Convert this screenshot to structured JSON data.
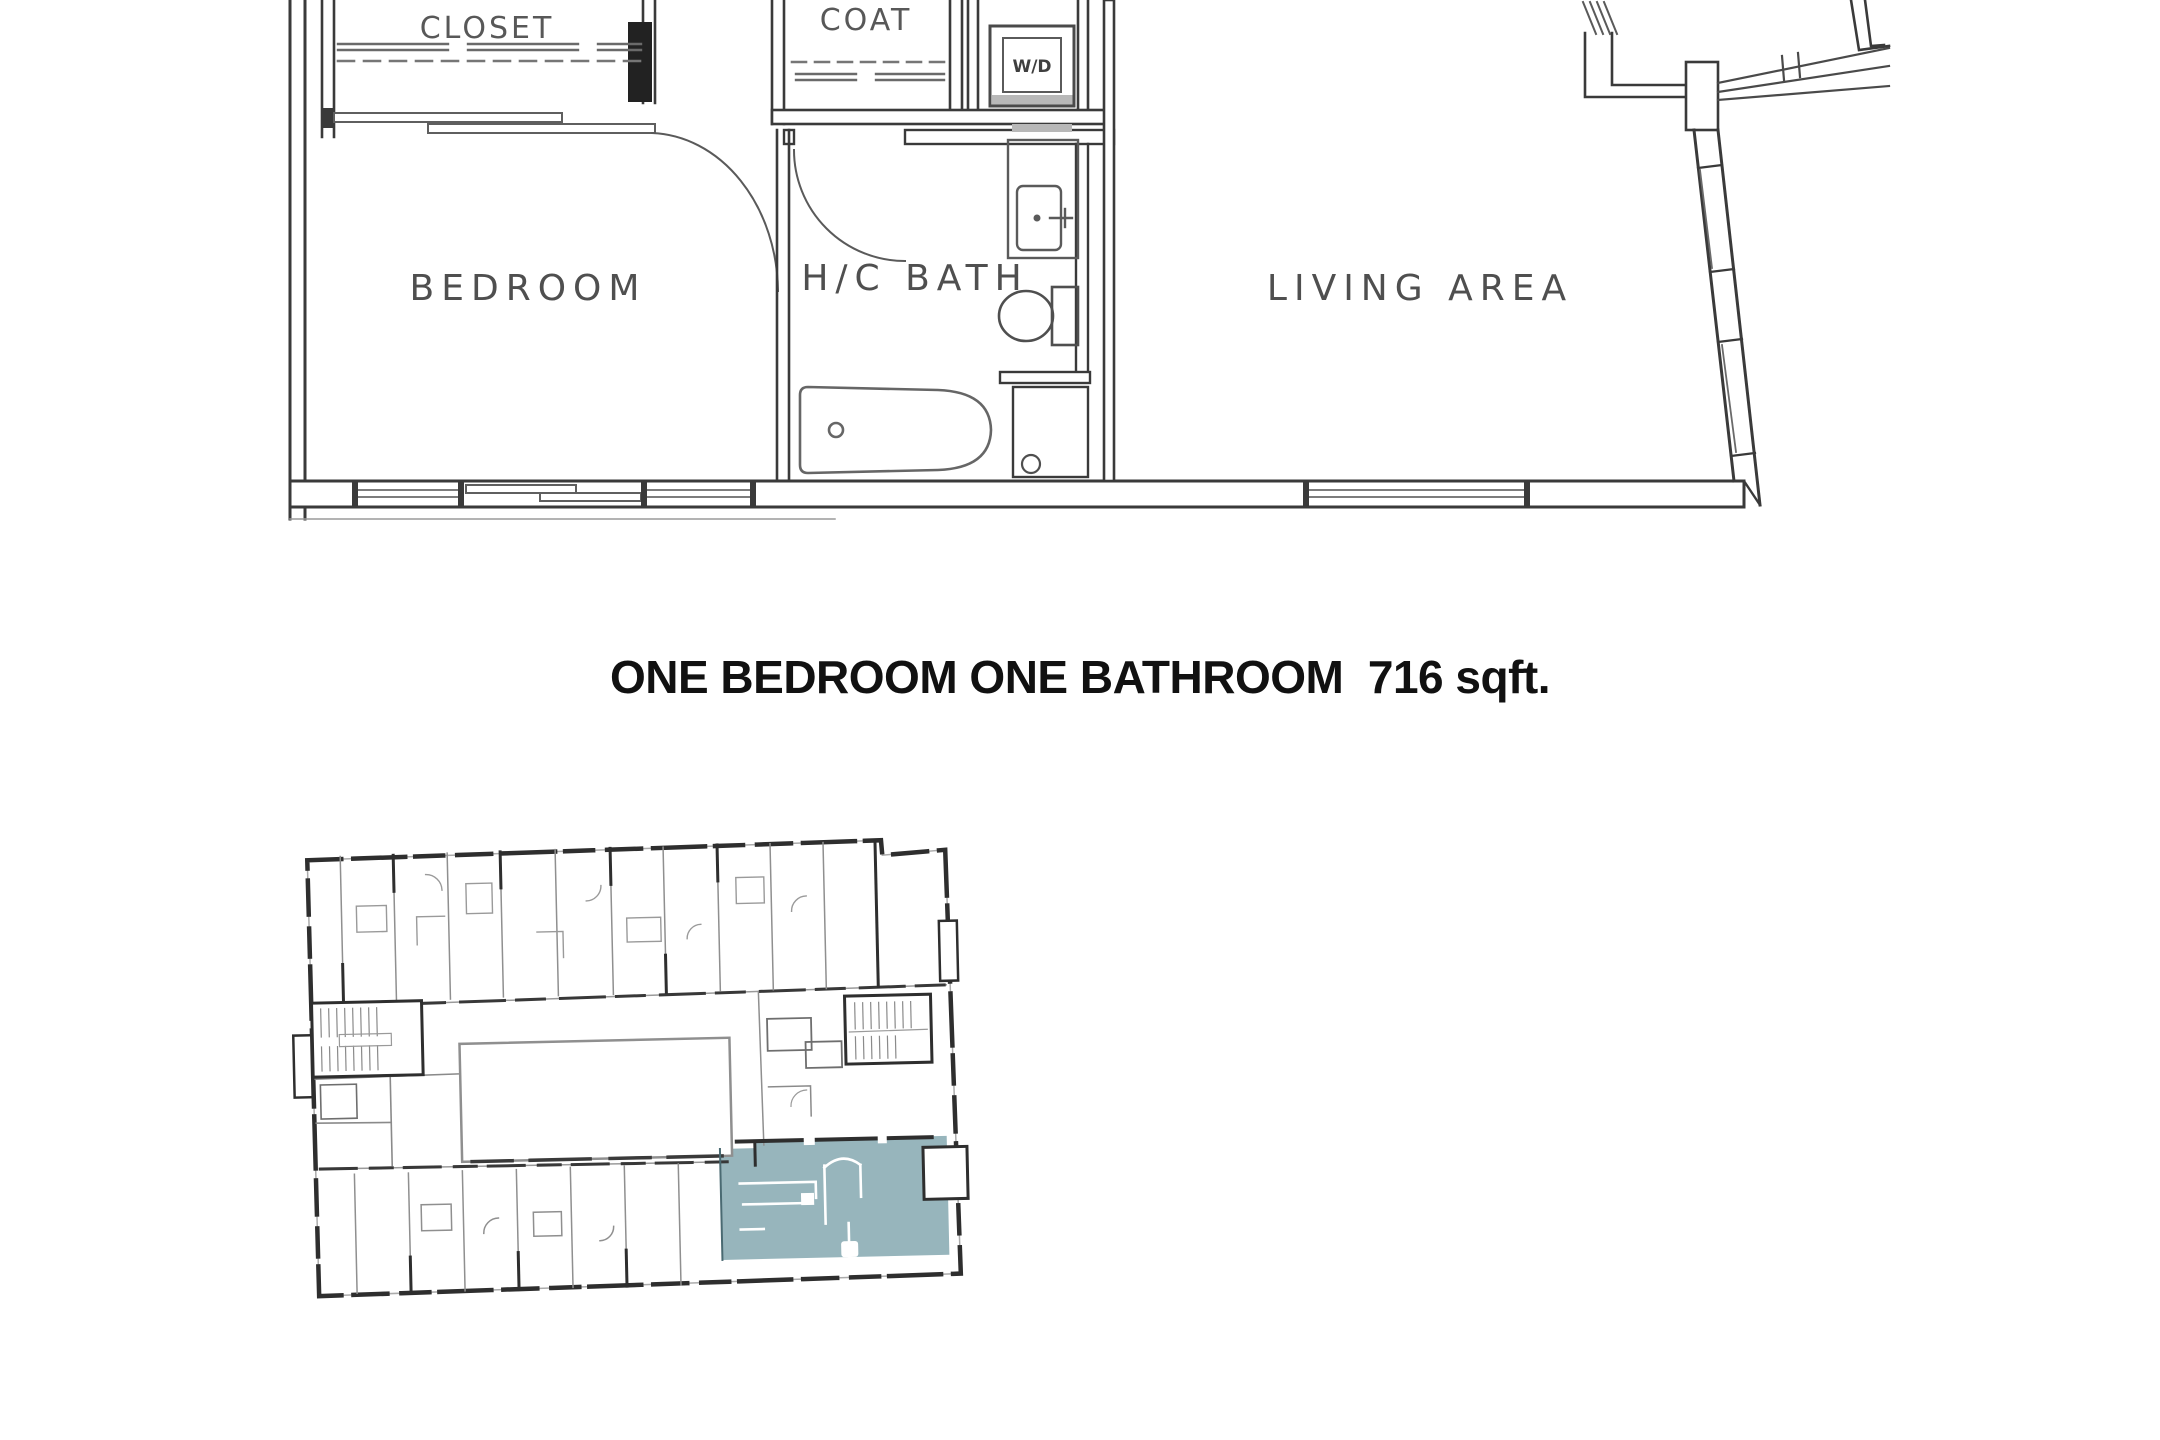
{
  "page": {
    "background_color": "#ffffff"
  },
  "floor_plan": {
    "rooms": {
      "closet": "CLOSET",
      "coat": "COAT",
      "washer_dryer": "W/D",
      "bedroom": "BEDROOM",
      "bath": "H/C BATH",
      "living": "LIVING AREA"
    }
  },
  "caption": "ONE BEDROOM ONE BATHROOM  716 sqft.",
  "key_plan": {
    "highlight_color": "#97b5bc",
    "wall_color": "#2e2e2e"
  },
  "colors": {
    "plan_wall": "#3a3a3a",
    "plan_thin_line": "#6a6a6a",
    "label_color": "#4f4f4f",
    "title_color": "#111111"
  }
}
